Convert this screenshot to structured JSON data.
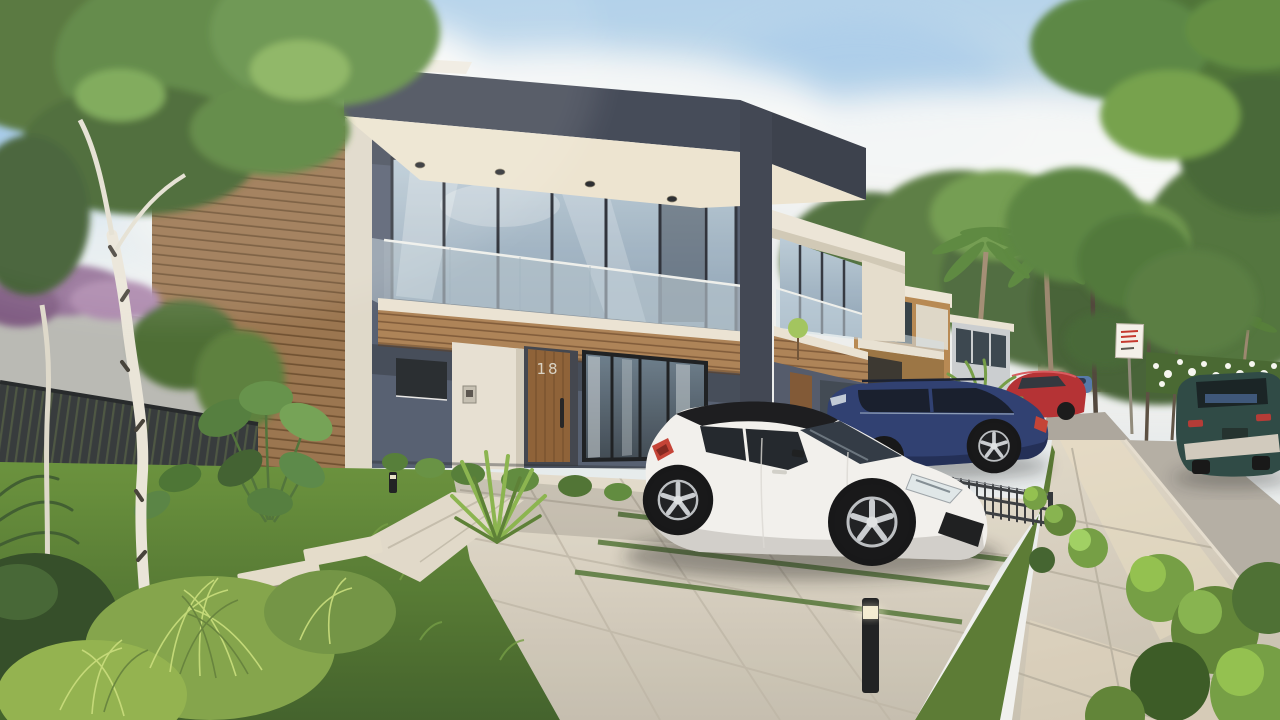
{
  "scene": {
    "type": "3d-architectural-rendering",
    "description": "Sunlit street of modern two-storey townhouses with slate and timber facades, glass balconies, landscaped front gardens, paver driveway, sidewalk and parked cars",
    "house_number": "18",
    "elements": [
      "duplex-house",
      "timber-clad-wall",
      "glass-balcony",
      "front-door",
      "intercom-panel",
      "soffit-downlights",
      "street-sign",
      "bollard-light",
      "railing-fence",
      "stepping-stones",
      "palm-trees",
      "birch-tree",
      "apartment-towers",
      "flowering-hedge"
    ],
    "vehicles": [
      {
        "name": "white-hatchback",
        "color": "#f2f1ef",
        "position": "front driveway"
      },
      {
        "name": "navy-suv",
        "color": "#26386e",
        "position": "neighbouring drive behind railing"
      },
      {
        "name": "red-sedan",
        "color": "#b22a2e",
        "position": "street, middle distance"
      },
      {
        "name": "compact-blue-car",
        "color": "#4f74a8",
        "position": "street, far"
      },
      {
        "name": "teal-suv",
        "color": "#254340",
        "position": "street, right edge"
      }
    ],
    "street_sign": {
      "shape": "small white rectangular sign on pole",
      "text": "illegible red lettering"
    }
  },
  "palette": {
    "sky_top": "#a8cdec",
    "sky_horizon": "#f1f2f1",
    "facade_slate": "#505a6e",
    "roof_fascia": "#3d4454",
    "soffit_cream": "#ece4d1",
    "timber_cladding": "#96704a",
    "balcony_timber": "#aa7f53",
    "door_timber": "#8a5c32",
    "house_number_metal": "#d8d2c4",
    "lawn_light": "#648f37",
    "lawn_dark": "#3b5c25",
    "driveway_light": "#e3dccd",
    "driveway_dark": "#c3bcae",
    "sidewalk": "#d6cfc1",
    "road": "#b1aca3",
    "car_white": "#f2f1ef",
    "car_navy": "#26386e",
    "car_red": "#b22a2e",
    "car_teal": "#254340",
    "car_compact_blue": "#4f74a8",
    "sign_red": "#c23026"
  }
}
